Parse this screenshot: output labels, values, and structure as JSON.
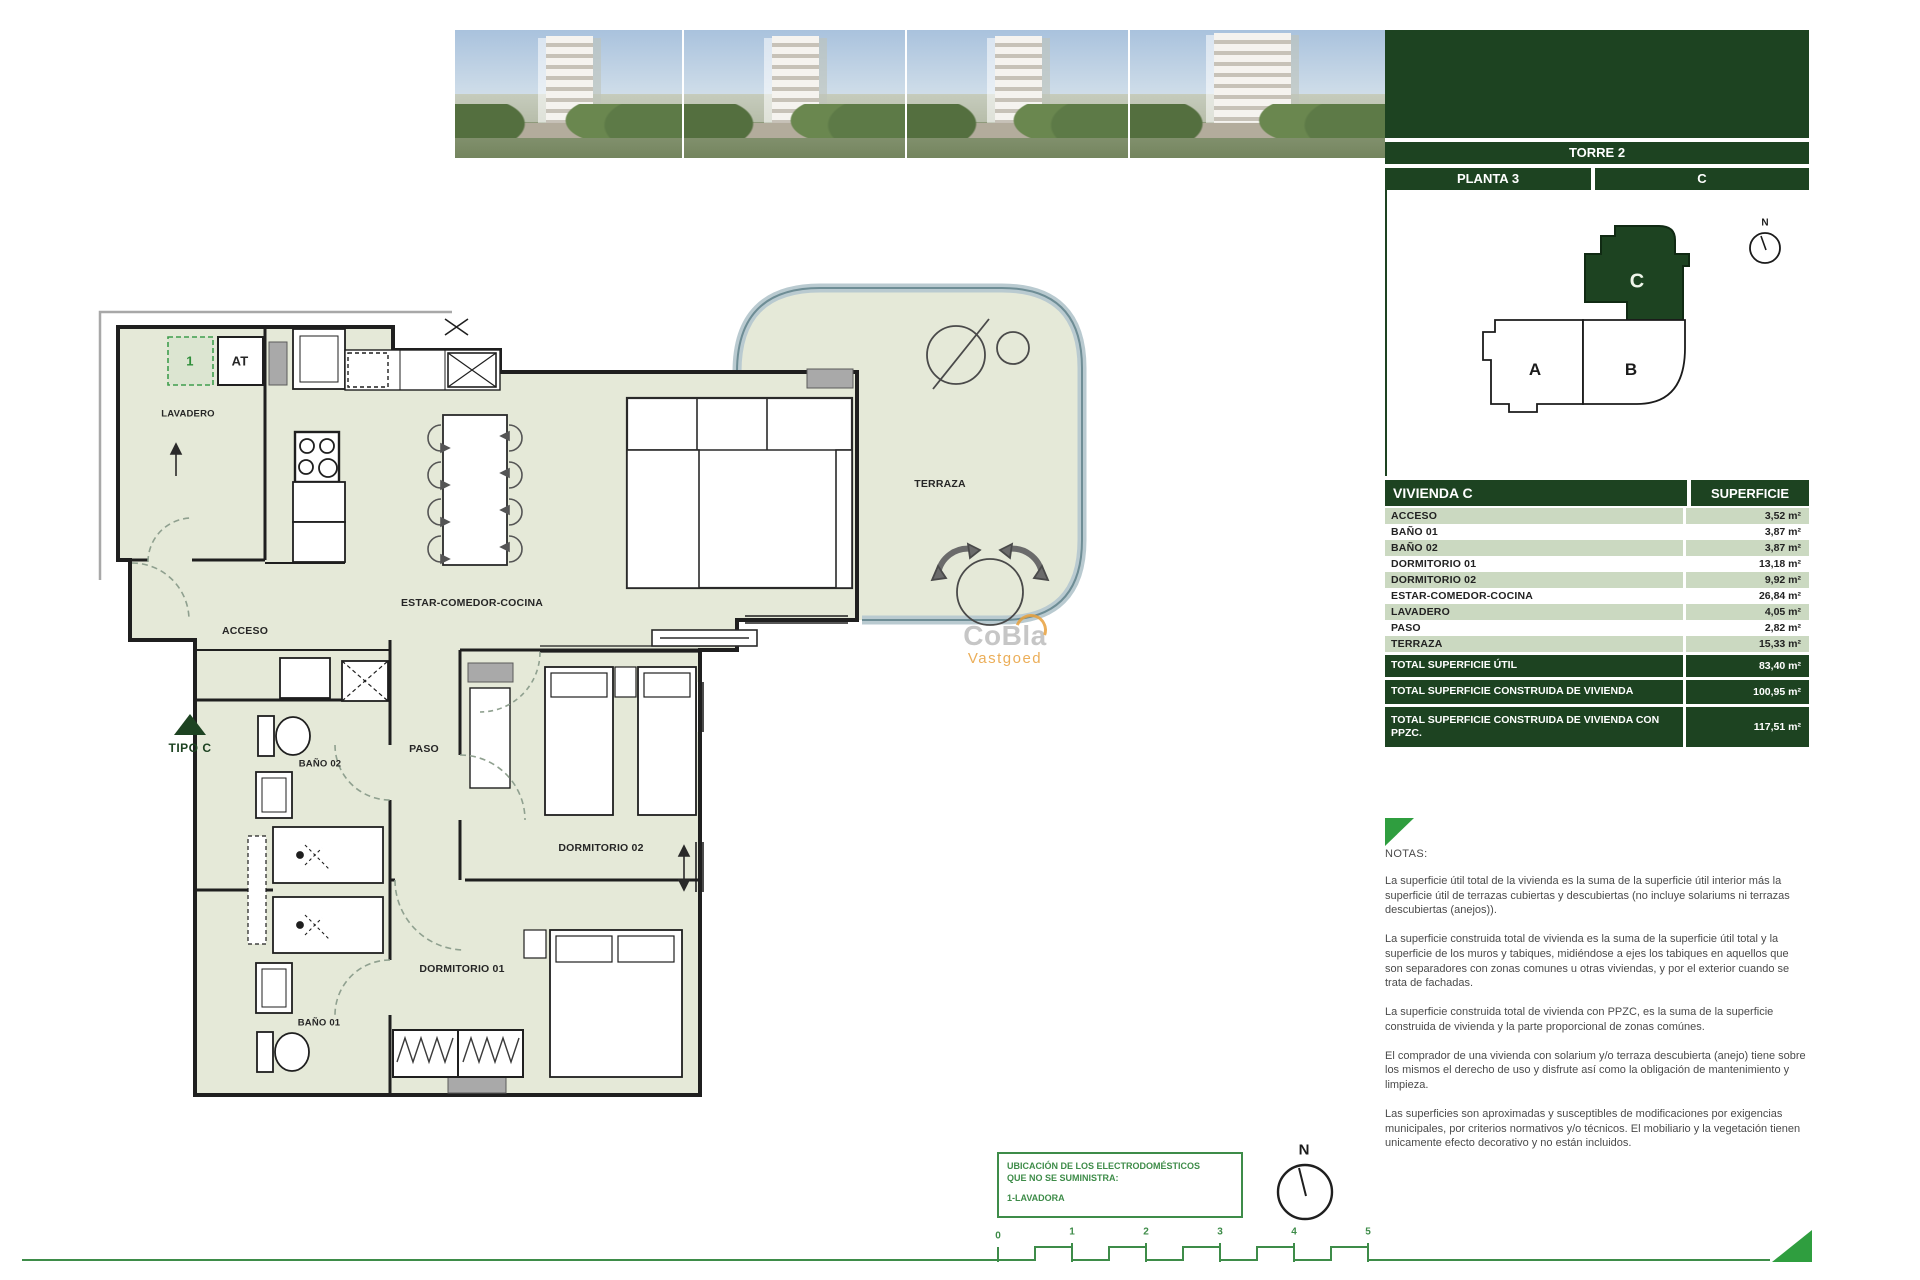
{
  "panel": {
    "tower": "TORRE 2",
    "floor": "PLANTA 3",
    "unit": "C",
    "keyplan": {
      "unit_a": "A",
      "unit_b": "B",
      "unit_c": "C",
      "north_label": "N"
    },
    "table": {
      "header": {
        "name": "VIVIENDA C",
        "value": "SUPERFICIE"
      },
      "rows": [
        {
          "name": "ACCESO",
          "value": "3,52 m²"
        },
        {
          "name": "BAÑO 01",
          "value": "3,87 m²"
        },
        {
          "name": "BAÑO 02",
          "value": "3,87 m²"
        },
        {
          "name": "DORMITORIO 01",
          "value": "13,18 m²"
        },
        {
          "name": "DORMITORIO 02",
          "value": "9,92 m²"
        },
        {
          "name": "ESTAR-COMEDOR-COCINA",
          "value": "26,84 m²"
        },
        {
          "name": "LAVADERO",
          "value": "4,05 m²"
        },
        {
          "name": "PASO",
          "value": "2,82 m²"
        },
        {
          "name": "TERRAZA",
          "value": "15,33 m²"
        }
      ],
      "totals": [
        {
          "name": "TOTAL SUPERFICIE ÚTIL",
          "value": "83,40 m²"
        },
        {
          "name": "TOTAL SUPERFICIE CONSTRUIDA DE VIVIENDA",
          "value": "100,95 m²"
        },
        {
          "name": "TOTAL SUPERFICIE CONSTRUIDA DE VIVIENDA CON PPZC.",
          "value": "117,51 m²"
        }
      ]
    },
    "notes": {
      "title": "NOTAS:",
      "paragraphs": [
        "La superficie útil total de la vivienda es la suma de la superficie útil interior más la superficie útil de terrazas cubiertas y descubiertas (no incluye solariums ni terrazas descubiertas (anejos)).",
        "La superficie construida total de vivienda es la suma de la superficie útil total y la superficie de los muros y tabiques, midiéndose a ejes los tabiques en aquellos que son separadores con zonas comunes u otras viviendas, y por el exterior cuando se trata de fachadas.",
        "La superficie construida total de vivienda con PPZC, es la suma de la superficie construida de vivienda y la parte proporcional de zonas comúnes.",
        "El comprador de una vivienda con solarium y/o terraza descubierta (anejo) tiene sobre los mismos el derecho de uso y disfrute así como la obligación de mantenimiento y limpieza.",
        "Las superficies son aproximadas y susceptibles de modificaciones por exigencias municipales, por criterios normativos y/o técnicos. El mobiliario y la vegetación tienen unicamente efecto decorativo y no están incluidos."
      ]
    }
  },
  "floor_plan": {
    "labels": {
      "lavadero": "LAVADERO",
      "acceso": "ACCESO",
      "estar": "ESTAR-COMEDOR-COCINA",
      "terraza": "TERRAZA",
      "paso": "PASO",
      "bano02": "BAÑO 02",
      "bano01": "BAÑO 01",
      "dorm01": "DORMITORIO 01",
      "dorm02": "DORMITORIO 02",
      "tipo": "TIPO C",
      "washer_mark": "1",
      "at_mark": "AT"
    },
    "north_label": "N"
  },
  "legend_box": {
    "line1": "UBICACIÓN DE LOS ELECTRODOMÉSTICOS QUE NO SE SUMINISTRA:",
    "line2": "1-LAVADORA"
  },
  "scale_bar": {
    "ticks": [
      "0",
      "1",
      "2",
      "3",
      "4",
      "5"
    ]
  },
  "watermark": {
    "line1": "CoBla",
    "line2": "Vastgoed"
  },
  "colors": {
    "dark_green": "#1d4321",
    "row_green": "#cbd9c1",
    "accent_green": "#3e8c49",
    "plan_fill": "#e5e9d8",
    "glass": "#b9cad0",
    "orange": "#e8a13d"
  }
}
